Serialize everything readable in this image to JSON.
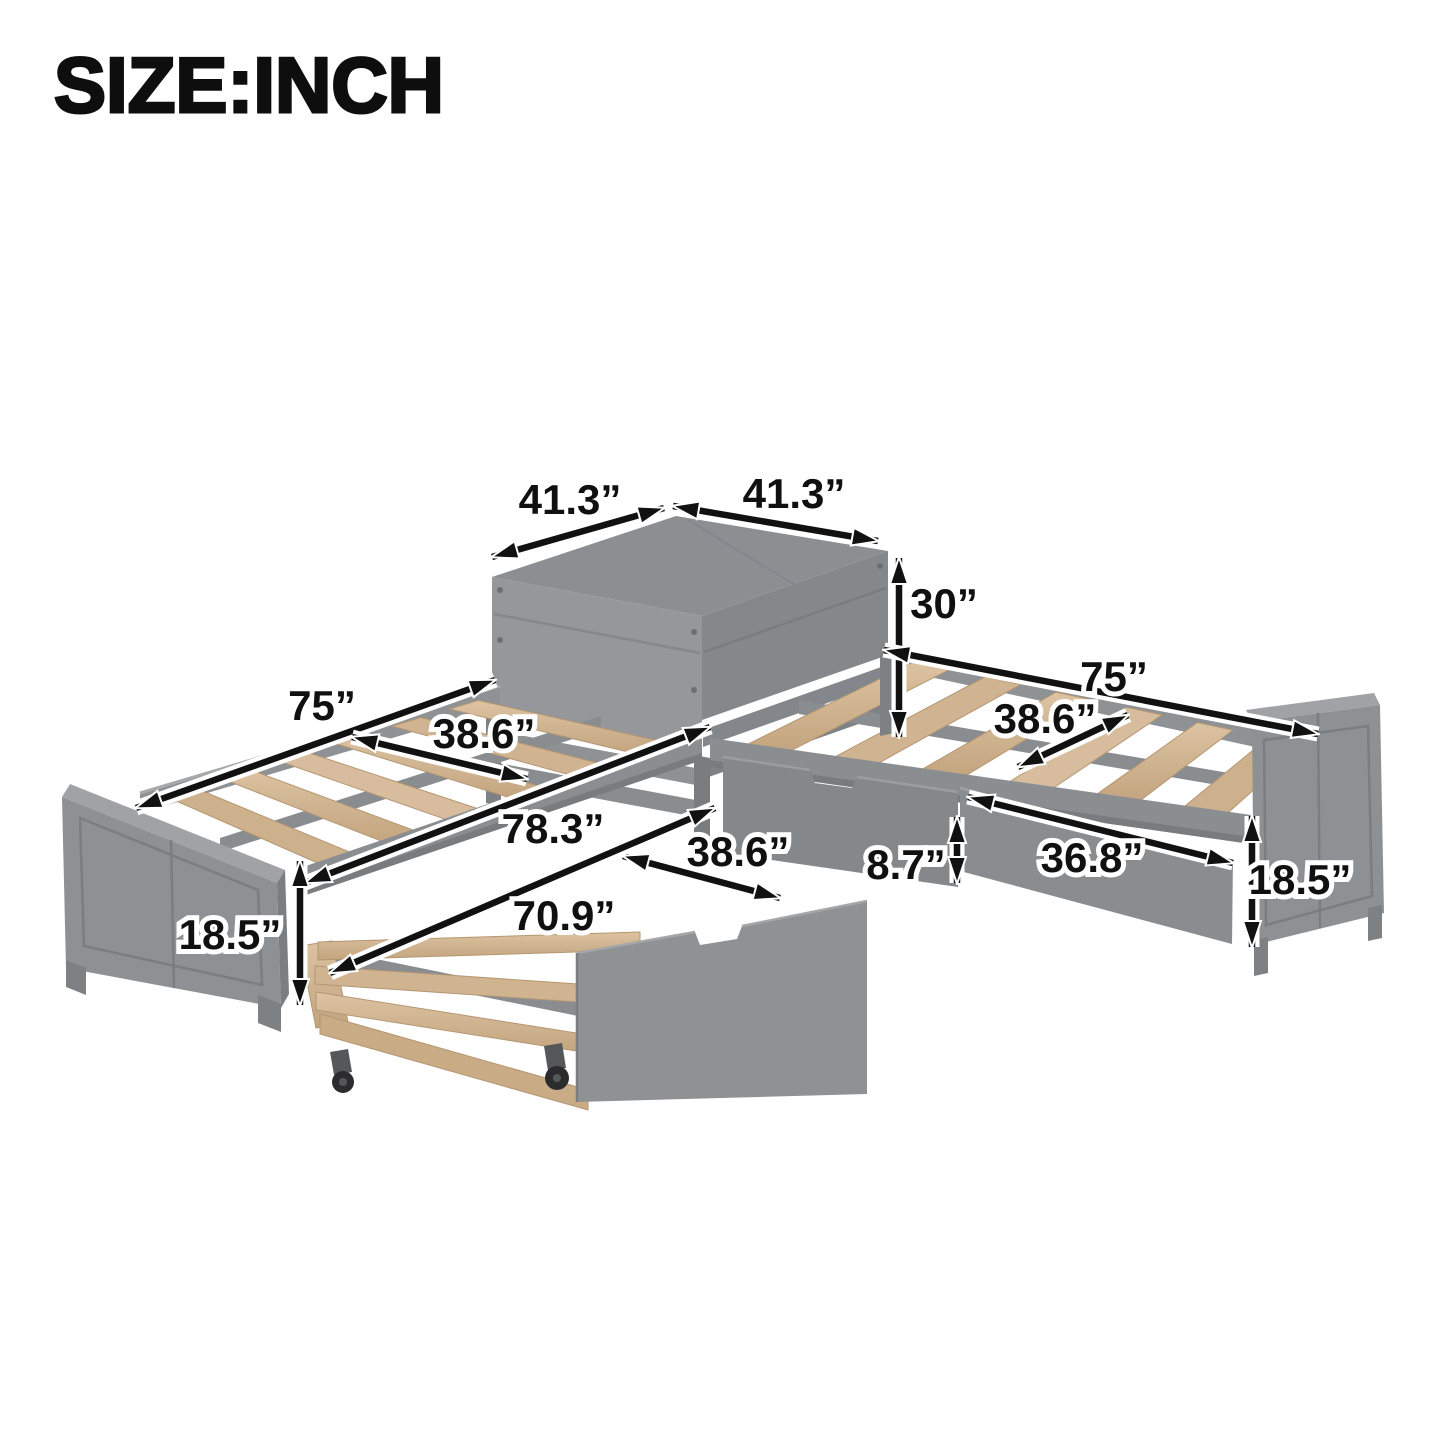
{
  "title": "SIZE:INCH",
  "colors": {
    "background": "#ffffff",
    "frame_gray_top": "#8c8f92",
    "frame_gray_light": "#95979b",
    "frame_gray_mid": "#85888b",
    "frame_gray_dark": "#767a7c",
    "slat_wood": "#d5bb9a",
    "slat_wood_dark": "#c5a783",
    "caster_black": "#2c2c2e",
    "annotation": "#111111"
  },
  "dimensions": {
    "table_top_left": "41.3”",
    "table_top_right": "41.3”",
    "table_height": "30”",
    "left_bed_length": "75”",
    "left_bed_slat_width": "38.6”",
    "left_bed_total_length": "78.3”",
    "left_bed_frame_height": "18.5”",
    "trundle_slat_width": "38.6”",
    "trundle_length": "70.9”",
    "trundle_frame_height": "8.7”",
    "right_bed_length": "75”",
    "right_bed_slat_width": "38.6”",
    "right_drawer_width": "36.8”",
    "right_bed_frame_height": "18.5”"
  }
}
